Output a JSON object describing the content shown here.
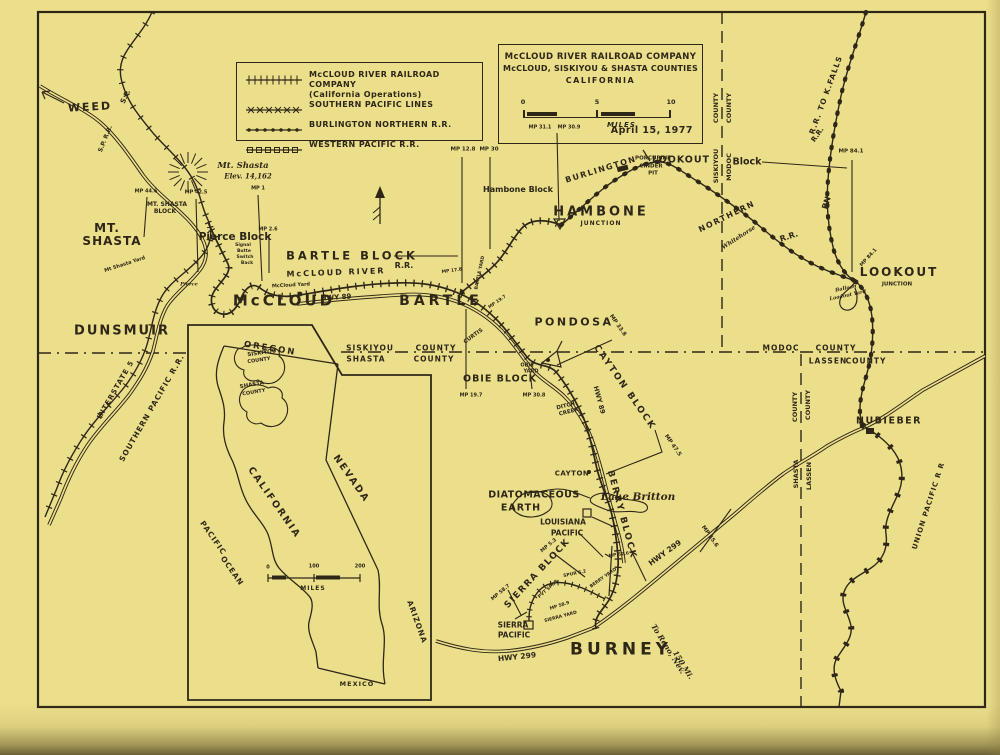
{
  "colors": {
    "paper": "#ecdf8b",
    "ink": "#2e2717"
  },
  "legend": {
    "items": [
      {
        "symbol": "ticks",
        "label": "McCLOUD RIVER RAILROAD COMPANY",
        "sublabel": "(California Operations)"
      },
      {
        "symbol": "xmarks",
        "label": "SOUTHERN PACIFIC LINES",
        "sublabel": ""
      },
      {
        "symbol": "dots",
        "label": "BURLINGTON NORTHERN R.R.",
        "sublabel": ""
      },
      {
        "symbol": "squares",
        "label": "WESTERN PACIFIC R.R.",
        "sublabel": ""
      }
    ]
  },
  "title_box": {
    "line1": "McCLOUD RIVER RAILROAD COMPANY",
    "line2": "McCLOUD, SISKIYOU & SHASTA COUNTIES",
    "line3": "CALIFORNIA",
    "scale_ticks": [
      "0",
      "5",
      "10"
    ],
    "scale_unit": "MILES",
    "date": "April 15, 1977"
  },
  "map": {
    "labels": [
      {
        "t": "WEED",
        "x": 90,
        "y": 107,
        "s": 11,
        "sp": 2,
        "r": -3,
        "n": "town-weed"
      },
      {
        "t": "MT.",
        "x": 107,
        "y": 228,
        "s": 12,
        "sp": 1,
        "n": "town-mt-shasta"
      },
      {
        "t": "SHASTA",
        "x": 112,
        "y": 241,
        "s": 12,
        "sp": 1,
        "n": "town-mt-shasta-2"
      },
      {
        "t": "DUNSMUIR",
        "x": 122,
        "y": 331,
        "s": 13,
        "sp": 2,
        "n": "town-dunsmuir"
      },
      {
        "t": "McCLOUD",
        "x": 284,
        "y": 301,
        "s": 15,
        "sp": 3,
        "n": "town-mccloud"
      },
      {
        "t": "BARTLE",
        "x": 441,
        "y": 301,
        "s": 14,
        "sp": 4,
        "n": "town-bartle"
      },
      {
        "t": "HAMBONE",
        "x": 601,
        "y": 212,
        "s": 13,
        "sp": 3,
        "n": "town-hambone"
      },
      {
        "t": "JUNCTION",
        "x": 601,
        "y": 224,
        "s": 6,
        "sp": 1,
        "n": "hambone-junction"
      },
      {
        "t": "LOOKOUT",
        "x": 899,
        "y": 272,
        "s": 12,
        "sp": 2,
        "n": "town-lookout"
      },
      {
        "t": "JUNCTION",
        "x": 897,
        "y": 285,
        "s": 5.5,
        "n": "lookout-junction"
      },
      {
        "t": "PONDOSA",
        "x": 574,
        "y": 322,
        "s": 11,
        "sp": 2.5,
        "n": "town-pondosa"
      },
      {
        "t": "NUBIEBER",
        "x": 889,
        "y": 421,
        "s": 9.5,
        "sp": 1.5,
        "n": "town-nubieber"
      },
      {
        "t": "BURNEY",
        "x": 621,
        "y": 650,
        "s": 17,
        "sp": 4,
        "n": "town-burney"
      },
      {
        "t": "CAYTON",
        "x": 572,
        "y": 474,
        "s": 7,
        "sp": 0.5,
        "n": "station-cayton"
      },
      {
        "t": "Lake Britton",
        "x": 638,
        "y": 497,
        "s": 10.5,
        "i": 1,
        "n": "lake-britton"
      },
      {
        "t": "DIATOMACEOUS",
        "x": 534,
        "y": 495,
        "s": 9.5,
        "sp": 0.5,
        "n": "diatomaceous-earth"
      },
      {
        "t": "EARTH",
        "x": 521,
        "y": 508,
        "s": 9.5,
        "sp": 1,
        "n": "diatomaceous-earth-2"
      },
      {
        "t": "Pierce Block",
        "x": 235,
        "y": 237,
        "s": 10.5,
        "n": "block-pierce"
      },
      {
        "t": "MT. SHASTA",
        "x": 167,
        "y": 205,
        "s": 6,
        "n": "block-mt-shasta"
      },
      {
        "t": "BLOCK",
        "x": 165,
        "y": 212,
        "s": 6,
        "n": "block-mt-shasta-2"
      },
      {
        "t": "BARTLE BLOCK",
        "x": 352,
        "y": 256,
        "s": 11.5,
        "sp": 3,
        "n": "block-bartle"
      },
      {
        "t": "Hambone Block",
        "x": 518,
        "y": 190,
        "s": 8,
        "n": "block-hambone"
      },
      {
        "t": "LOOKOUT",
        "x": 681,
        "y": 160,
        "s": 9.5,
        "sp": 1,
        "n": "block-lookout"
      },
      {
        "t": "Block",
        "x": 747,
        "y": 162,
        "s": 9.5,
        "n": "block-lookout-2"
      },
      {
        "t": "OBIE BLOCK",
        "x": 500,
        "y": 379,
        "s": 9.5,
        "sp": 1,
        "n": "block-obie"
      },
      {
        "t": "CAYTON BLOCK",
        "x": 624,
        "y": 388,
        "s": 9,
        "sp": 2,
        "r": 55,
        "n": "block-cayton"
      },
      {
        "t": "BERRY BLOCK",
        "x": 621,
        "y": 515,
        "s": 9,
        "sp": 2,
        "r": 75,
        "n": "block-berry"
      },
      {
        "t": "SIERRA BLOCK",
        "x": 538,
        "y": 574,
        "s": 9,
        "sp": 1.5,
        "r": -47,
        "n": "block-sierra"
      },
      {
        "t": "S.P.",
        "x": 126,
        "y": 97,
        "s": 7,
        "r": -65,
        "n": "rr-sp"
      },
      {
        "t": "S.P. R.R.",
        "x": 106,
        "y": 139,
        "s": 6,
        "r": -68,
        "n": "rr-sp-2"
      },
      {
        "t": "INTERSTATE 5",
        "x": 116,
        "y": 390,
        "s": 7,
        "sp": 1,
        "r": -60,
        "n": "hwy-interstate-5"
      },
      {
        "t": "SOUTHERN PACIFIC R.R.",
        "x": 152,
        "y": 408,
        "s": 7.5,
        "sp": 1,
        "r": -60,
        "n": "rr-southern-pacific"
      },
      {
        "t": "McCLOUD RIVER",
        "x": 336,
        "y": 273,
        "s": 8,
        "sp": 2,
        "r": -2,
        "n": "rr-mccloud-river"
      },
      {
        "t": "R.R.",
        "x": 404,
        "y": 266,
        "s": 8,
        "n": "rr-mccloud-river-2"
      },
      {
        "t": "HWY 89",
        "x": 336,
        "y": 298,
        "s": 7,
        "r": -4,
        "n": "hwy-89"
      },
      {
        "t": "BURLINGTON",
        "x": 601,
        "y": 170,
        "s": 8,
        "sp": 1.5,
        "r": -17,
        "n": "rr-burlington"
      },
      {
        "t": "NORTHERN",
        "x": 727,
        "y": 217,
        "s": 8,
        "sp": 1.5,
        "r": -26,
        "n": "rr-northern"
      },
      {
        "t": "Whitehorse",
        "x": 739,
        "y": 238,
        "s": 6,
        "i": 1,
        "r": -33,
        "n": "whitehorse"
      },
      {
        "t": "R.R.",
        "x": 789,
        "y": 237,
        "s": 8,
        "r": -18,
        "n": "rr-northern-2"
      },
      {
        "t": "R.R.",
        "x": 818,
        "y": 135,
        "s": 7,
        "r": -55,
        "n": "rr-bn-upper"
      },
      {
        "t": "BN",
        "x": 827,
        "y": 203,
        "s": 8,
        "r": -72,
        "n": "rr-bn"
      },
      {
        "t": "R.R. TO K.FALLS",
        "x": 826,
        "y": 95,
        "s": 7.5,
        "sp": 1,
        "r": -70,
        "n": "rr-to-kfalls"
      },
      {
        "t": "UNION PACIFIC R R",
        "x": 929,
        "y": 506,
        "s": 7,
        "sp": 1,
        "r": -72,
        "n": "rr-union-pacific"
      },
      {
        "t": "LOUISIANA",
        "x": 563,
        "y": 522,
        "s": 7.5,
        "n": "louisiana-pacific"
      },
      {
        "t": "PACIFIC",
        "x": 567,
        "y": 533,
        "s": 7.5,
        "n": "louisiana-pacific-2"
      },
      {
        "t": "SIERRA",
        "x": 513,
        "y": 625,
        "s": 7.5,
        "n": "sierra-pacific"
      },
      {
        "t": "PACIFIC",
        "x": 514,
        "y": 635,
        "s": 7.5,
        "n": "sierra-pacific-2"
      },
      {
        "t": "HWY 299",
        "x": 517,
        "y": 657,
        "s": 7.5,
        "r": -6,
        "n": "hwy-299"
      },
      {
        "t": "HWY 299",
        "x": 665,
        "y": 553,
        "s": 7.5,
        "r": -36,
        "n": "hwy-299-ne"
      },
      {
        "t": "HWY 89",
        "x": 599,
        "y": 400,
        "s": 6.5,
        "r": 75,
        "n": "hwy-89-south"
      },
      {
        "t": "To Reno, Nev.",
        "x": 668,
        "y": 649,
        "s": 7.5,
        "i": 1,
        "r": 58,
        "n": "to-reno"
      },
      {
        "t": "150 Mi.",
        "x": 683,
        "y": 665,
        "s": 7.5,
        "i": 1,
        "r": 58,
        "n": "to-reno-2"
      },
      {
        "t": "Mt. Shasta",
        "x": 243,
        "y": 166,
        "s": 8.5,
        "i": 1,
        "n": "mt-shasta-peak"
      },
      {
        "t": "Elev. 14,162",
        "x": 248,
        "y": 176,
        "s": 7,
        "i": 1,
        "n": "mt-shasta-elev"
      },
      {
        "t": "PORCUPINE",
        "x": 653,
        "y": 159,
        "s": 5.5,
        "n": "porcupine-pit"
      },
      {
        "t": "CINDER",
        "x": 651,
        "y": 167,
        "s": 5.5,
        "n": "porcupine-pit-2"
      },
      {
        "t": "PIT",
        "x": 653,
        "y": 174,
        "s": 5.5,
        "n": "porcupine-pit-3"
      },
      {
        "t": "McCloud Yard",
        "x": 291,
        "y": 286,
        "s": 5,
        "r": -3,
        "n": "yard-mccloud"
      },
      {
        "t": "Mt Shasta Yard",
        "x": 125,
        "y": 265,
        "s": 5,
        "r": -18,
        "n": "yard-mt-shasta"
      },
      {
        "t": "BARTLE YARD",
        "x": 481,
        "y": 273,
        "s": 4.5,
        "r": -78,
        "n": "yard-bartle"
      },
      {
        "t": "BERRY YARD",
        "x": 604,
        "y": 579,
        "s": 4.5,
        "r": -35,
        "n": "yard-berry"
      },
      {
        "t": "Balloon",
        "x": 846,
        "y": 289,
        "s": 5,
        "i": 1,
        "r": -12,
        "n": "balloon-loadout"
      },
      {
        "t": "Loadout Yard",
        "x": 848,
        "y": 296,
        "s": 5,
        "i": 1,
        "r": -12,
        "n": "balloon-loadout-2"
      },
      {
        "t": "Signal",
        "x": 243,
        "y": 246,
        "s": 4.5,
        "n": "signal-butte"
      },
      {
        "t": "Butte",
        "x": 244,
        "y": 252,
        "s": 4.5,
        "n": "signal-butte-2"
      },
      {
        "t": "Switch",
        "x": 245,
        "y": 258,
        "s": 4.5,
        "n": "signal-butte-3"
      },
      {
        "t": "Back",
        "x": 247,
        "y": 264,
        "s": 4.5,
        "n": "signal-butte-4"
      },
      {
        "t": "Pierce",
        "x": 189,
        "y": 285,
        "s": 5,
        "i": 1,
        "n": "station-pierce"
      },
      {
        "t": "CURTIS",
        "x": 474,
        "y": 337,
        "s": 5.5,
        "r": -36,
        "n": "station-curtis"
      },
      {
        "t": "OBIE",
        "x": 527,
        "y": 366,
        "s": 5,
        "n": "station-obie"
      },
      {
        "t": "YARD",
        "x": 531,
        "y": 372,
        "s": 5,
        "n": "station-obie-2"
      },
      {
        "t": "DITCH",
        "x": 566,
        "y": 407,
        "s": 5.5,
        "r": -14,
        "n": "ditch-creek"
      },
      {
        "t": "CREEK",
        "x": 569,
        "y": 413,
        "s": 5.5,
        "r": -14,
        "n": "ditch-creek-2"
      },
      {
        "t": "SIERRA YARD",
        "x": 561,
        "y": 618,
        "s": 4.5,
        "r": -15,
        "n": "yard-sierra"
      },
      {
        "t": "SISKIYOU",
        "x": 370,
        "y": 348,
        "s": 7.5,
        "sp": 1,
        "n": "county-siskiyou"
      },
      {
        "t": "SHASTA",
        "x": 366,
        "y": 359,
        "s": 7.5,
        "sp": 1,
        "n": "county-shasta"
      },
      {
        "t": "COUNTY",
        "x": 436,
        "y": 348,
        "s": 7.5,
        "sp": 1,
        "n": "county-word-1"
      },
      {
        "t": "COUNTY",
        "x": 434,
        "y": 359,
        "s": 7.5,
        "sp": 1,
        "n": "county-word-2"
      },
      {
        "t": "MODOC",
        "x": 781,
        "y": 348,
        "s": 7.5,
        "sp": 1,
        "n": "county-modoc"
      },
      {
        "t": "COUNTY",
        "x": 836,
        "y": 348,
        "s": 7.5,
        "sp": 1,
        "n": "county-word-3"
      },
      {
        "t": "LASSEN",
        "x": 828,
        "y": 361,
        "s": 7.5,
        "sp": 1,
        "n": "county-lassen"
      },
      {
        "t": "COUNTY",
        "x": 866,
        "y": 361,
        "s": 7.5,
        "sp": 1,
        "n": "county-word-4"
      },
      {
        "t": "COUNTY",
        "x": 716,
        "y": 108,
        "s": 6.5,
        "r": -90,
        "n": "county-word-5"
      },
      {
        "t": "COUNTY",
        "x": 729,
        "y": 108,
        "s": 6.5,
        "r": -90,
        "n": "county-word-6"
      },
      {
        "t": "SISKIYOU",
        "x": 716,
        "y": 166,
        "s": 6.5,
        "r": -90,
        "n": "county-siskiyou-v"
      },
      {
        "t": "MODOC",
        "x": 729,
        "y": 167,
        "s": 6.5,
        "r": -90,
        "n": "county-modoc-v"
      },
      {
        "t": "COUNTY",
        "x": 795,
        "y": 407,
        "s": 6.5,
        "r": -90,
        "n": "county-word-7"
      },
      {
        "t": "COUNTY",
        "x": 808,
        "y": 405,
        "s": 6.5,
        "r": -90,
        "n": "county-word-8"
      },
      {
        "t": "SHASTA",
        "x": 796,
        "y": 474,
        "s": 6.5,
        "r": -90,
        "n": "county-shasta-v"
      },
      {
        "t": "LASSEN",
        "x": 809,
        "y": 476,
        "s": 6.5,
        "r": -90,
        "n": "county-lassen-v"
      },
      {
        "t": "OREGON",
        "x": 270,
        "y": 349,
        "s": 8.5,
        "sp": 2,
        "r": 9,
        "n": "inset-oregon"
      },
      {
        "t": "SISKIYOU",
        "x": 262,
        "y": 354,
        "s": 5.5,
        "r": -8,
        "n": "inset-siskiyou"
      },
      {
        "t": "COUNTY",
        "x": 259,
        "y": 361,
        "s": 5,
        "r": -8,
        "n": "inset-siskiyou-2"
      },
      {
        "t": "SHASTA",
        "x": 252,
        "y": 386,
        "s": 5.5,
        "r": -10,
        "n": "inset-shasta"
      },
      {
        "t": "COUNTY",
        "x": 254,
        "y": 393,
        "s": 5,
        "r": -10,
        "n": "inset-shasta-2"
      },
      {
        "t": "CALIFORNIA",
        "x": 274,
        "y": 503,
        "s": 9.5,
        "sp": 2,
        "r": 55,
        "n": "inset-california"
      },
      {
        "t": "NEVADA",
        "x": 351,
        "y": 479,
        "s": 9.5,
        "sp": 2,
        "r": 55,
        "n": "inset-nevada"
      },
      {
        "t": "ARIZONA",
        "x": 417,
        "y": 622,
        "s": 7.5,
        "sp": 1,
        "r": 70,
        "n": "inset-arizona"
      },
      {
        "t": "PACIFIC",
        "x": 213,
        "y": 538,
        "s": 7.5,
        "sp": 1,
        "r": 55,
        "n": "inset-pacific"
      },
      {
        "t": "OCEAN",
        "x": 232,
        "y": 571,
        "s": 7.5,
        "sp": 1,
        "r": 55,
        "n": "inset-ocean"
      },
      {
        "t": "MEXICO",
        "x": 357,
        "y": 684,
        "s": 6.5,
        "sp": 1,
        "n": "inset-mexico"
      },
      {
        "t": "0",
        "x": 268,
        "y": 568,
        "s": 5,
        "n": "inset-scale-0"
      },
      {
        "t": "100",
        "x": 314,
        "y": 567,
        "s": 5,
        "n": "inset-scale-100"
      },
      {
        "t": "200",
        "x": 360,
        "y": 567,
        "s": 5,
        "n": "inset-scale-200"
      },
      {
        "t": "MILES",
        "x": 313,
        "y": 589,
        "s": 6,
        "sp": 1,
        "n": "inset-scale-miles"
      },
      {
        "t": "MP 44.6",
        "x": 146,
        "y": 192,
        "s": 5,
        "n": "milepost-44-6"
      },
      {
        "t": "MP 42.5",
        "x": 196,
        "y": 193,
        "s": 5,
        "n": "milepost-42-5"
      },
      {
        "t": "MP 1",
        "x": 258,
        "y": 189,
        "s": 5,
        "n": "milepost-1"
      },
      {
        "t": "MP 2.6",
        "x": 268,
        "y": 230,
        "s": 5,
        "n": "milepost-2-6"
      },
      {
        "t": "MP 12.8",
        "x": 463,
        "y": 150,
        "s": 5.5,
        "n": "milepost-12-8"
      },
      {
        "t": "MP 30",
        "x": 489,
        "y": 150,
        "s": 5.5,
        "n": "milepost-30"
      },
      {
        "t": "MP 31.1",
        "x": 540,
        "y": 128,
        "s": 5,
        "n": "milepost-31-1"
      },
      {
        "t": "MP 30.9",
        "x": 569,
        "y": 128,
        "s": 5,
        "n": "milepost-30-9"
      },
      {
        "t": "MP 84.1",
        "x": 851,
        "y": 152,
        "s": 5.5,
        "n": "milepost-84-1"
      },
      {
        "t": "MP 84.1",
        "x": 869,
        "y": 258,
        "s": 5,
        "r": -48,
        "n": "milepost-84-1b"
      },
      {
        "t": "MP 17.8",
        "x": 452,
        "y": 272,
        "s": 4.5,
        "r": -8,
        "n": "milepost-17-8"
      },
      {
        "t": "MP 19.7",
        "x": 498,
        "y": 303,
        "s": 4.5,
        "r": -35,
        "n": "milepost-19-7"
      },
      {
        "t": "MP 19.7",
        "x": 471,
        "y": 396,
        "s": 5,
        "n": "milepost-19-7b"
      },
      {
        "t": "MP 30.8",
        "x": 534,
        "y": 396,
        "s": 5,
        "n": "milepost-30-8"
      },
      {
        "t": "MP 33.8",
        "x": 617,
        "y": 326,
        "s": 5.5,
        "r": 55,
        "n": "milepost-33-8"
      },
      {
        "t": "MP 47.5",
        "x": 672,
        "y": 446,
        "s": 5.5,
        "r": 55,
        "n": "milepost-47-5"
      },
      {
        "t": "MP 55.6",
        "x": 709,
        "y": 537,
        "s": 5.5,
        "r": 55,
        "n": "milepost-55-6"
      },
      {
        "t": "MP 52.6",
        "x": 619,
        "y": 556,
        "s": 4.5,
        "r": -8,
        "n": "milepost-52-6"
      },
      {
        "t": "MP 5.3",
        "x": 549,
        "y": 546,
        "s": 5,
        "r": -40,
        "n": "milepost-5-3"
      },
      {
        "t": "MP 58.7",
        "x": 501,
        "y": 593,
        "s": 5,
        "r": -40,
        "n": "milepost-58-7"
      },
      {
        "t": "MP 58.9",
        "x": 560,
        "y": 607,
        "s": 4.5,
        "r": -18,
        "n": "milepost-58-9"
      },
      {
        "t": "SPUR 5.2",
        "x": 575,
        "y": 575,
        "s": 4.5,
        "r": -12,
        "n": "spur-5-2"
      },
      {
        "t": "PVT SPUR",
        "x": 549,
        "y": 590,
        "s": 4.5,
        "r": -42,
        "n": "pvt-spur"
      }
    ]
  }
}
